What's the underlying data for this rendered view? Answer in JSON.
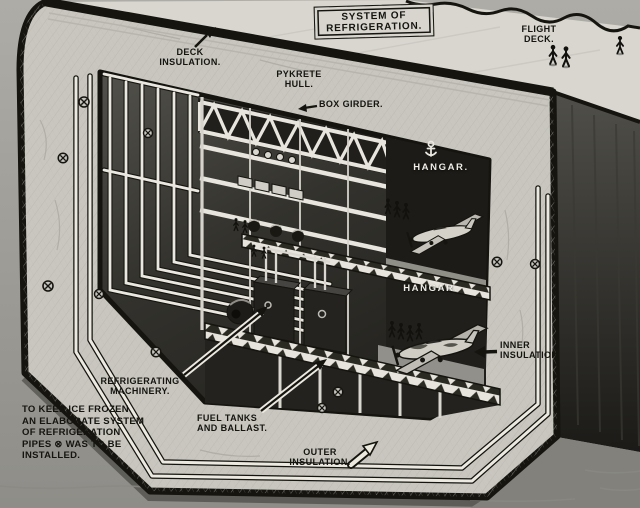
{
  "figure": {
    "type": "cutaway-diagram",
    "subject": "Pykrete aircraft-carrier hull cross-section showing refrigeration system",
    "title_box": {
      "line1": "SYSTEM OF",
      "line2": "REFRIGERATION."
    },
    "callouts": {
      "deck_insulation": "DECK\nINSULATION.",
      "pykrete_hull": "PYKRETE\nHULL.",
      "box_girder": "BOX GIRDER.",
      "flight_deck": "FLIGHT\nDECK.",
      "hangar_upper": "HANGAR.",
      "hangar_lower": "HANGAR.",
      "inner_insulation": "INNER\nINSULATION",
      "refrigerating_machinery": "REFRIGERATING\nMACHINERY.",
      "fuel_tanks": "FUEL TANKS\nAND BALLAST.",
      "outer_insulation": "OUTER\nINSULATION."
    },
    "note": "TO KEEP ICE FROZEN\nAN ELABORATE SYSTEM\nOF REFRIGERATION\nPIPES ⊗ WAS TO BE\nINSTALLED.",
    "icons": {
      "pipe_cross_section": "⊗",
      "anchor": "⚓"
    },
    "colors": {
      "background": "#a19f9a",
      "pykrete": "#c8c6bf",
      "interior": "#33322d",
      "ink": "#15140f",
      "pipe": "#ece9e1",
      "deck": "#d8d6cf",
      "ship_side": "#2e2d29",
      "label_white": "#efede5"
    }
  }
}
